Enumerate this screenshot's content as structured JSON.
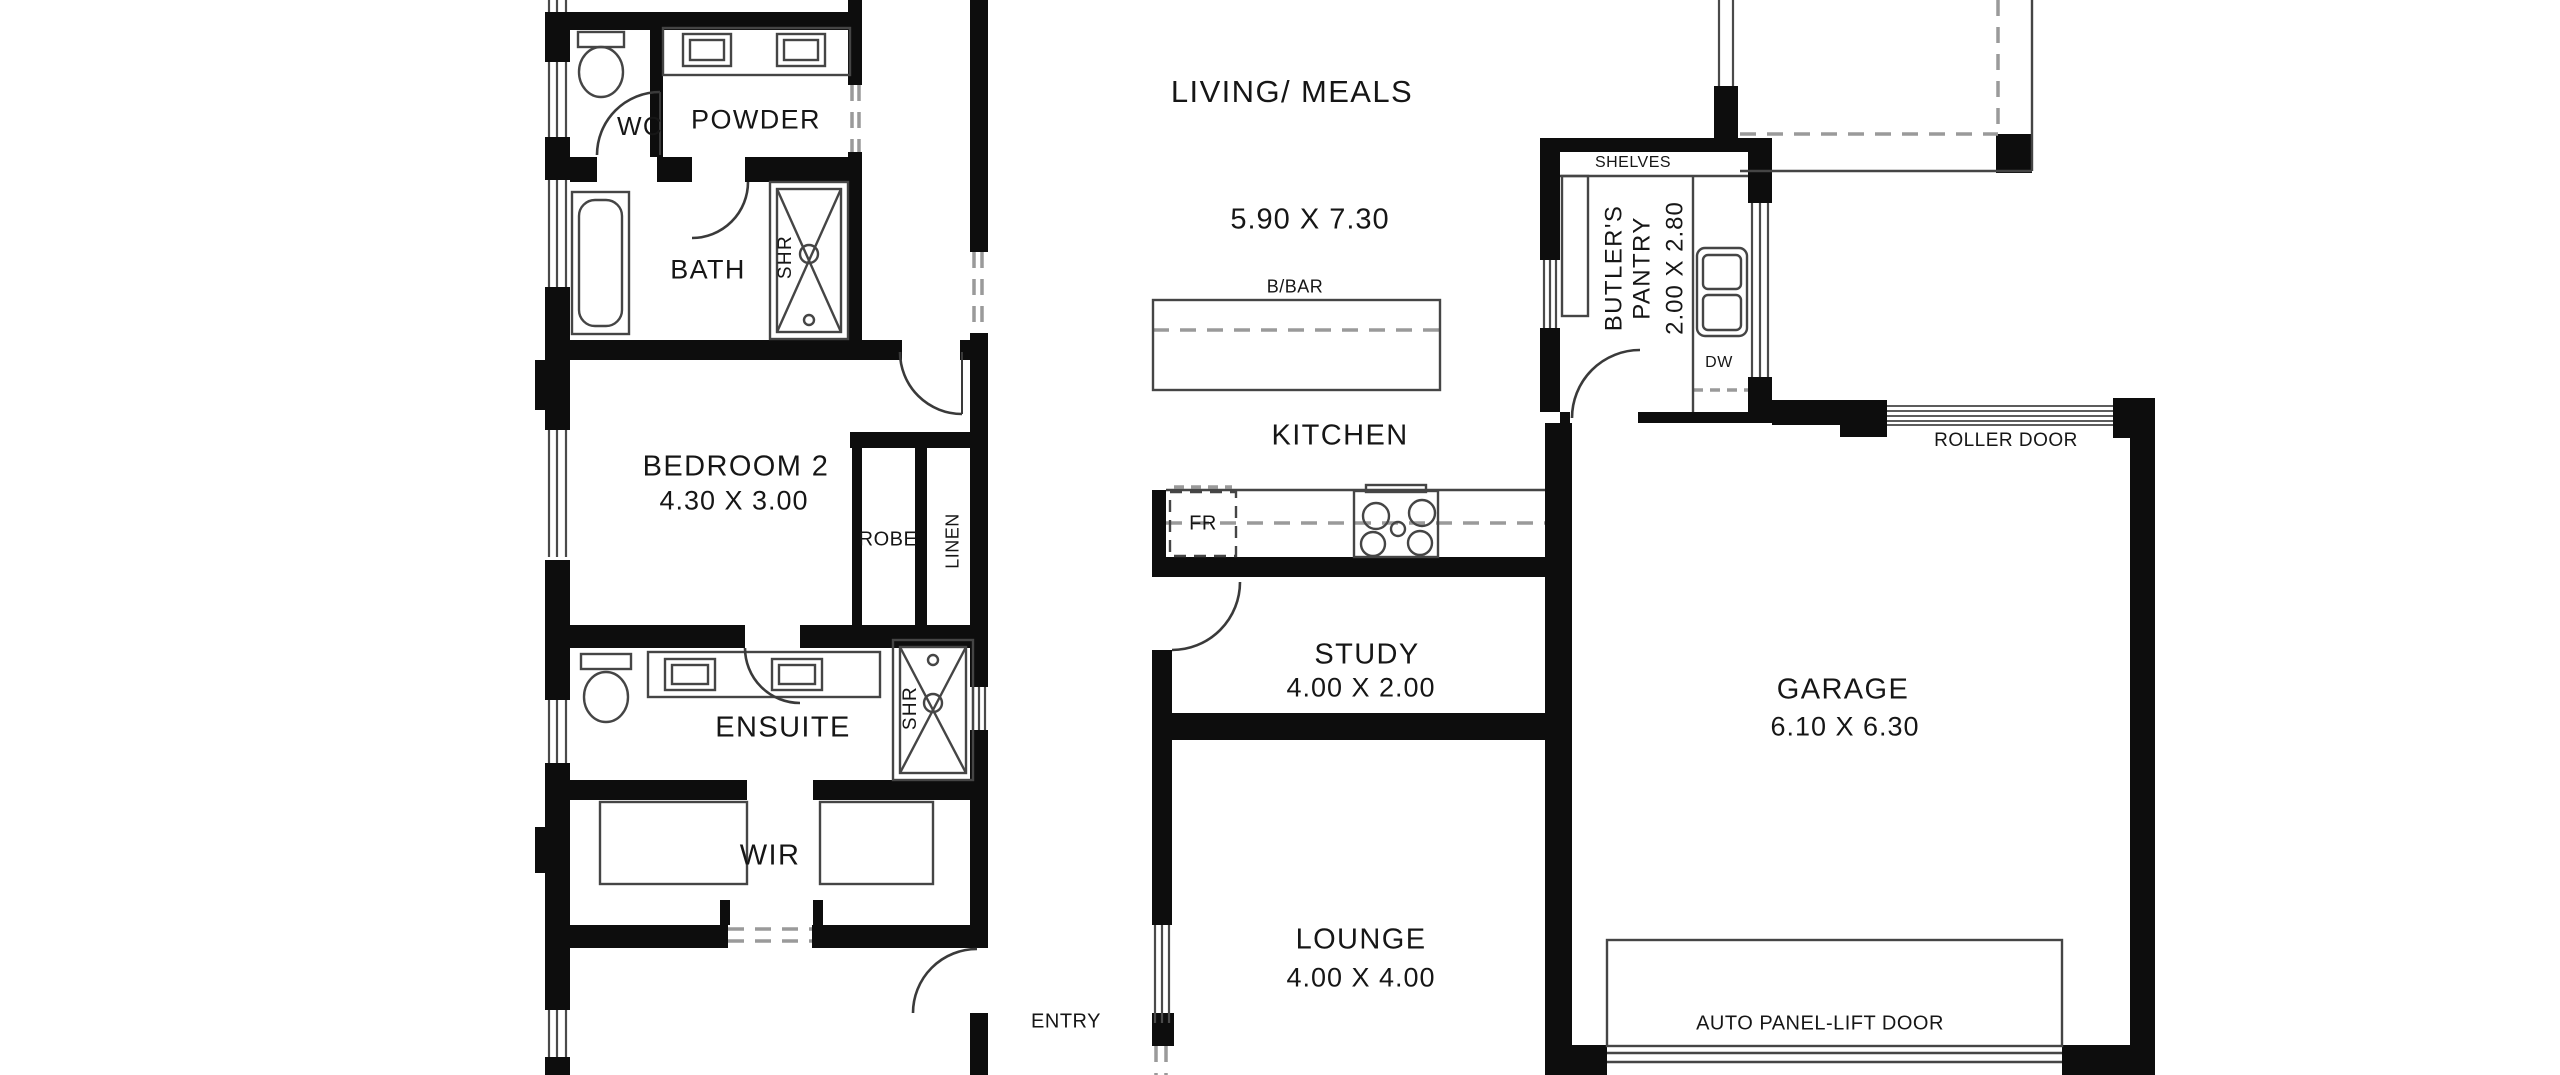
{
  "plan": {
    "type": "floor-plan",
    "background": "#ffffff",
    "wall_color": "#0d0d0d",
    "line_color": "#454545",
    "dash_color": "#9a9a9a",
    "rooms": {
      "wc": {
        "label": "WC"
      },
      "powder": {
        "label": "POWDER"
      },
      "bath": {
        "label": "BATH"
      },
      "bedroom2": {
        "label": "BEDROOM 2",
        "dims": "4.30 X 3.00"
      },
      "ensuite": {
        "label": "ENSUITE"
      },
      "wir": {
        "label": "WIR"
      },
      "living_meals": {
        "label": "LIVING/ MEALS",
        "dims": "5.90 X 7.30"
      },
      "kitchen": {
        "label": "KITCHEN"
      },
      "study": {
        "label": "STUDY",
        "dims": "4.00 X 2.00"
      },
      "lounge": {
        "label": "LOUNGE",
        "dims": "4.00 X 4.00"
      },
      "entry": {
        "label": "ENTRY"
      },
      "butlers_pantry": {
        "label_line1": "BUTLER'S",
        "label_line2": "PANTRY",
        "dims": "2.00 X 2.80"
      },
      "garage": {
        "label": "GARAGE",
        "dims": "6.10 X 6.30"
      }
    },
    "fixtures": {
      "shower_bath": "SHR",
      "shower_ensuite": "SHR",
      "robe": "ROBE",
      "linen": "LINEN",
      "breakfast_bar": "B/BAR",
      "fridge": "FR",
      "shelves": "SHELVES",
      "dishwasher": "DW",
      "roller_door": "ROLLER DOOR",
      "panel_lift_door": "AUTO PANEL-LIFT DOOR"
    }
  }
}
